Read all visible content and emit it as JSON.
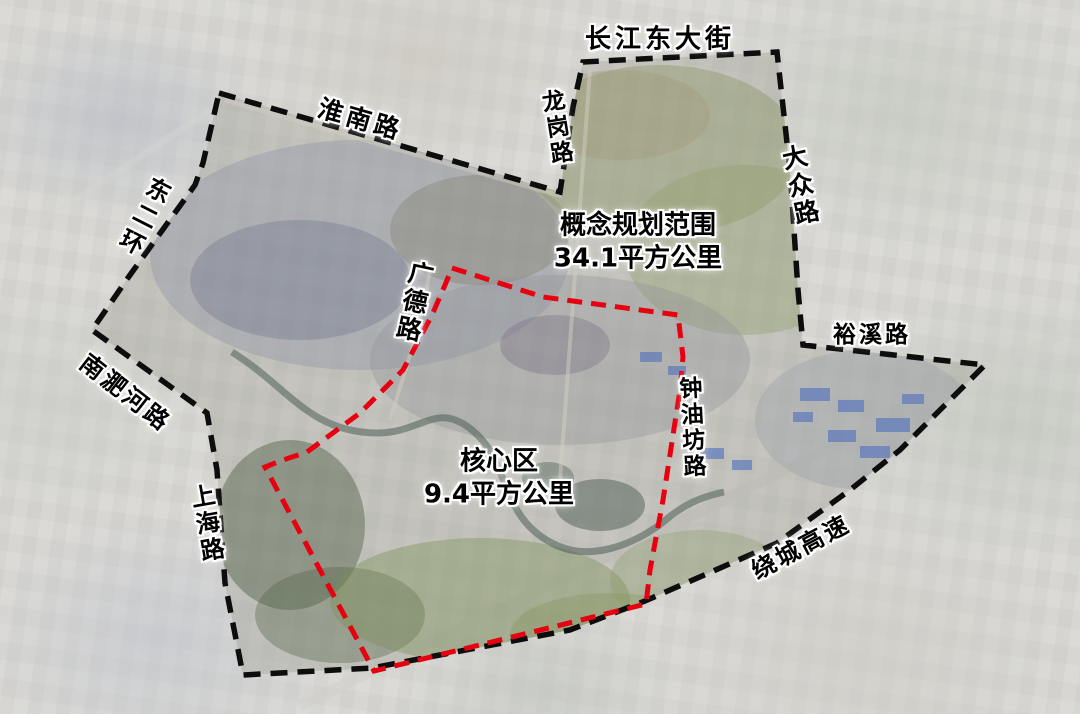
{
  "map": {
    "planning_area": {
      "title": "概念规划范围",
      "area": "34.1平方公里"
    },
    "core_area": {
      "title": "核心区",
      "area": "9.4平方公里"
    },
    "roads": [
      {
        "name": "长江东大街"
      },
      {
        "name": "淮南路"
      },
      {
        "name": "龙岗路"
      },
      {
        "name": "东二环"
      },
      {
        "name": "大众路"
      },
      {
        "name": "裕溪路"
      },
      {
        "name": "南淝河路"
      },
      {
        "name": "广德路"
      },
      {
        "name": "钟油坊路"
      },
      {
        "name": "上海路"
      },
      {
        "name": "绕城高速"
      }
    ],
    "colors": {
      "planning_boundary": "#0d0d0d",
      "core_boundary": "#e60010"
    }
  }
}
